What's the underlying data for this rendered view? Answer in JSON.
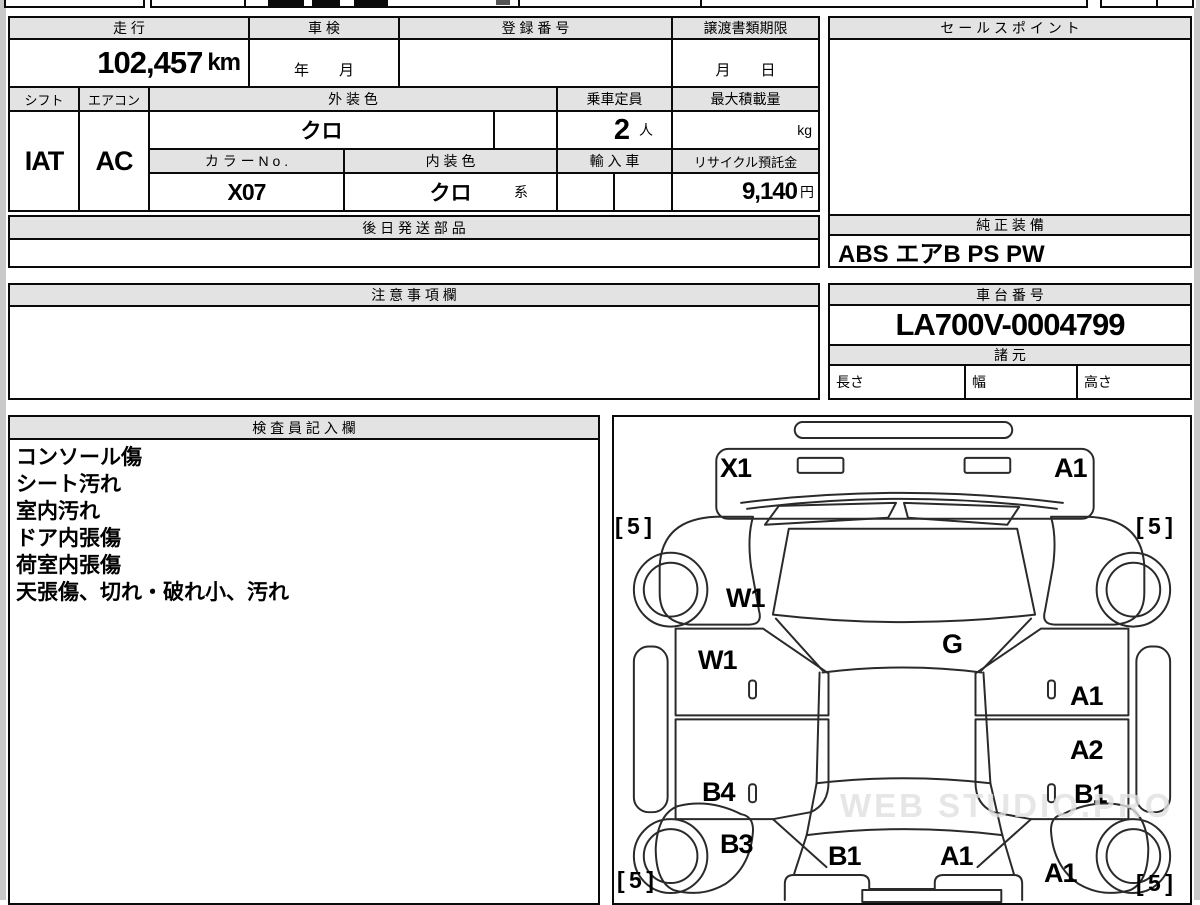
{
  "sheet": {
    "top_table": {
      "mileage_label": "走 行",
      "mileage_value": "102,457",
      "mileage_unit": "km",
      "shaken_label": "車 検",
      "shaken_value": "年　　月",
      "registration_label": "登 録 番 号",
      "registration_value": "",
      "deadline_label": "譲渡書類期限",
      "deadline_value": "月　　日",
      "shift_label": "シフト",
      "shift_value": "IAT",
      "aircon_label": "エアコン",
      "aircon_value": "AC",
      "exterior_color_label": "外 装 色",
      "exterior_color_value": "クロ",
      "capacity_label": "乗車定員",
      "capacity_value": "2",
      "capacity_unit": "人",
      "max_load_label": "最大積載量",
      "max_load_value": "",
      "max_load_unit": "kg",
      "color_no_label": "カ ラ ー N o .",
      "color_no_value": "X07",
      "interior_color_label": "内 装 色",
      "interior_color_value": "クロ",
      "interior_color_suffix": "系",
      "import_label": "輸 入 車",
      "import_value": "",
      "recycle_label": "リサイクル預託金",
      "recycle_value": "9,140",
      "recycle_unit": "円"
    },
    "sales_point": {
      "label": "セ ー ル ス ポ イ ン ト",
      "value": ""
    },
    "later_parts": {
      "label": "後 日 発 送 部 品",
      "value": ""
    },
    "genuine_equipment": {
      "label": "純 正 装 備",
      "value": "ABS エアB PS PW"
    },
    "notes": {
      "label": "注 意 事 項 欄",
      "value": ""
    },
    "chassis": {
      "label": "車 台 番 号",
      "value": "LA700V-0004799"
    },
    "specs": {
      "label": "諸 元",
      "length_label": "長さ",
      "length_value": "",
      "width_label": "幅",
      "width_value": "",
      "height_label": "高さ",
      "height_value": ""
    },
    "inspector": {
      "label": "検 査 員 記 入 欄",
      "lines": [
        "コンソール傷",
        "シート汚れ",
        "室内汚れ",
        "ドア内張傷",
        "荷室内張傷",
        "天張傷、切れ・破れ小、汚れ"
      ]
    },
    "diagram": {
      "watermark": "WEB STUDIO.PRO",
      "labels": [
        {
          "text": "X1",
          "x": 106,
          "y": 36,
          "fs": 27
        },
        {
          "text": "A1",
          "x": 440,
          "y": 36,
          "fs": 27
        },
        {
          "text": "[ 5 ]",
          "x": 1,
          "y": 96,
          "fs": 23
        },
        {
          "text": "[ 5 ]",
          "x": 522,
          "y": 96,
          "fs": 23
        },
        {
          "text": "W1",
          "x": 112,
          "y": 166,
          "fs": 27
        },
        {
          "text": "W1",
          "x": 84,
          "y": 228,
          "fs": 27
        },
        {
          "text": "G",
          "x": 328,
          "y": 212,
          "fs": 27
        },
        {
          "text": "A1",
          "x": 456,
          "y": 264,
          "fs": 27
        },
        {
          "text": "A2",
          "x": 456,
          "y": 318,
          "fs": 27
        },
        {
          "text": "B1",
          "x": 460,
          "y": 362,
          "fs": 27
        },
        {
          "text": "B4",
          "x": 88,
          "y": 360,
          "fs": 27
        },
        {
          "text": "B3",
          "x": 106,
          "y": 412,
          "fs": 27
        },
        {
          "text": "B1",
          "x": 214,
          "y": 424,
          "fs": 27
        },
        {
          "text": "A1",
          "x": 326,
          "y": 424,
          "fs": 27
        },
        {
          "text": "A1",
          "x": 430,
          "y": 441,
          "fs": 27
        },
        {
          "text": "[ 5 ]",
          "x": 3,
          "y": 450,
          "fs": 23
        },
        {
          "text": "[ 5 ]",
          "x": 522,
          "y": 453,
          "fs": 23
        }
      ]
    }
  }
}
